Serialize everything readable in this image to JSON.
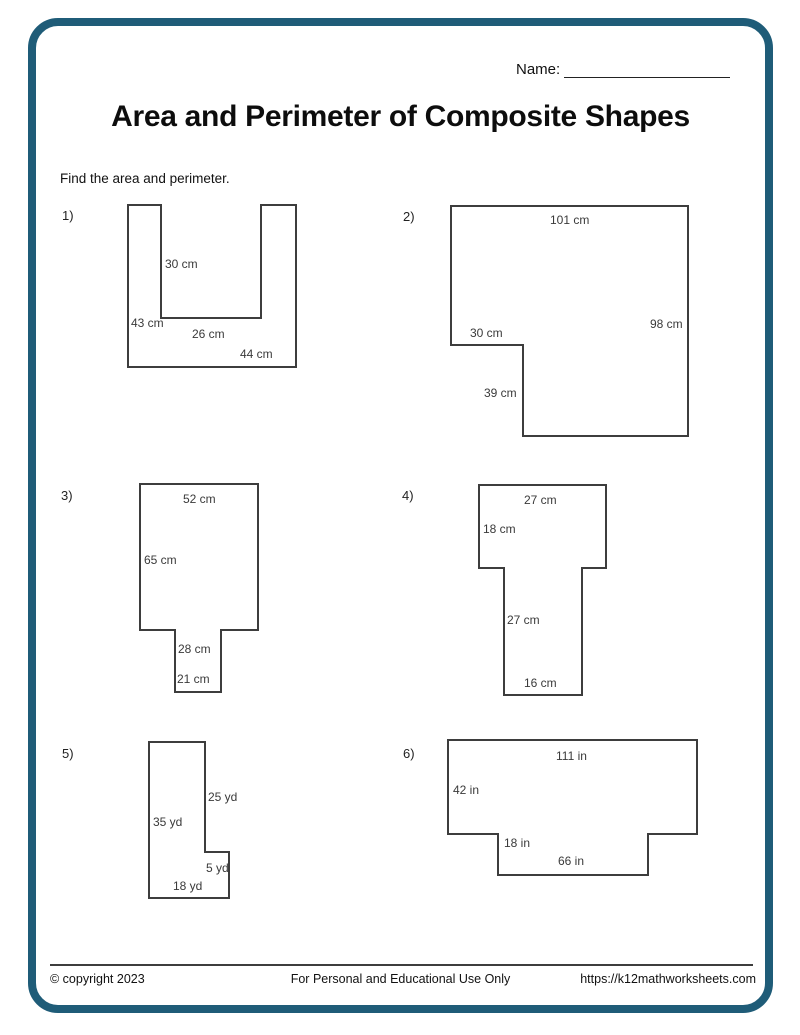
{
  "header": {
    "name_label": "Name:",
    "title": "Area and Perimeter of Composite Shapes",
    "instruction": "Find the area and perimeter."
  },
  "problems": [
    {
      "number": "1)",
      "dimensions": [
        "30 cm",
        "43 cm",
        "26 cm",
        "44 cm"
      ]
    },
    {
      "number": "2)",
      "dimensions": [
        "101 cm",
        "98 cm",
        "30 cm",
        "39 cm"
      ]
    },
    {
      "number": "3)",
      "dimensions": [
        "52 cm",
        "65 cm",
        "28 cm",
        "21 cm"
      ]
    },
    {
      "number": "4)",
      "dimensions": [
        "27 cm",
        "18 cm",
        "27 cm",
        "16 cm"
      ]
    },
    {
      "number": "5)",
      "dimensions": [
        "25 yd",
        "35 yd",
        "5 yd",
        "18 yd"
      ]
    },
    {
      "number": "6)",
      "dimensions": [
        "111 in",
        "42 in",
        "18 in",
        "66 in"
      ]
    }
  ],
  "footer": {
    "copyright": "© copyright 2023",
    "usage": "For Personal and Educational Use Only",
    "url": "https://k12mathworksheets.com"
  },
  "colors": {
    "frame": "#1f5c78",
    "shape_stroke": "#3d3d3d"
  }
}
